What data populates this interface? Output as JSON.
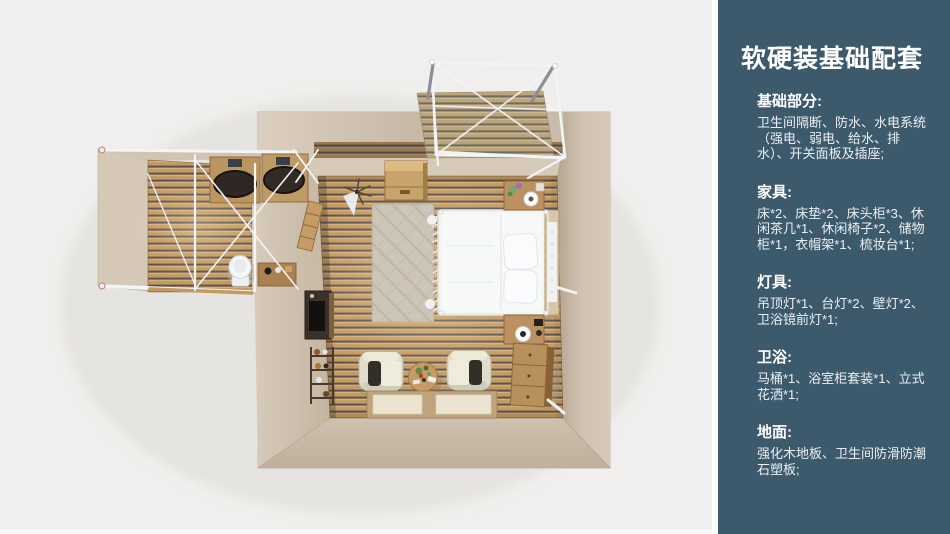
{
  "page": {
    "background": "#f0efed",
    "divider_color": "#ffffff"
  },
  "panel": {
    "background": "#3d5a6d",
    "title": "软硬装基础配套",
    "title_color": "#ffffff",
    "body_color": "#eaf0f3",
    "sections": [
      {
        "heading": "基础部分:",
        "body": "卫生间隔断、防水、水电系统（强电、弱电、给水、排水）、开关面板及插座;"
      },
      {
        "heading": "家具:",
        "body": "床*2、床垫*2、床头柜*3、休闲茶几*1、休闲椅子*2、储物柜*1，衣帽架*1、梳妆台*1;"
      },
      {
        "heading": "灯具:",
        "body": "吊顶灯*1、台灯*2、壁灯*2、卫浴镜前灯*1;"
      },
      {
        "heading": "卫浴:",
        "body": "马桶*1、浴室柜套装*1、立式花洒*1;"
      },
      {
        "heading": "地面:",
        "body": "强化木地板、卫生间防滑防潮石塑板;"
      }
    ]
  },
  "floorplan": {
    "type": "top-down 3D render of a bedroom suite with ensuite bathroom and balcony",
    "palette": {
      "wall_beige": "#ccbeac",
      "wall_light": "#dbcfc0",
      "floor_wood": "#c59a60",
      "floor_stripe": "#55525a",
      "deck_wood": "#bba276",
      "frame_white": "#f3f4f7",
      "bedding_white": "#f2f4f5",
      "furniture_wood": "#bb9161",
      "rug": "#cdc5b7",
      "chair_cream": "#dfdccc",
      "cushion_dark": "#332e28"
    }
  }
}
